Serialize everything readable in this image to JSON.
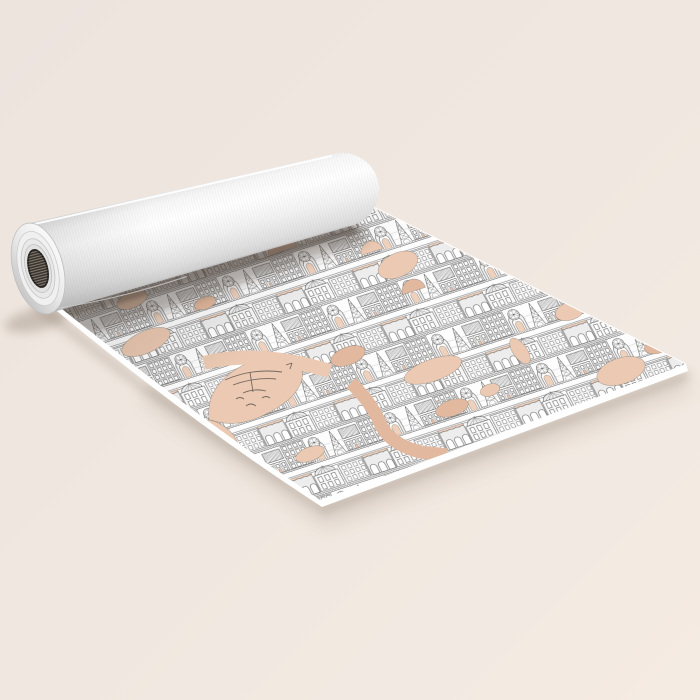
{
  "image": {
    "alt": "Yoga mat partially unrolled on a cream floor, printed with a black and white Paris architectural toile pattern with blush peach accents; the far end is rolled up showing a white roll with a dark core"
  },
  "colors": {
    "background_top": "#ece4dd",
    "background_bottom": "#f4ebe3",
    "mat_base": "#fdfdfd",
    "ink": "#3f3e3d",
    "accent_peach": "#ebc9b2",
    "accent_peach_deep": "#e2b89e",
    "mat_edge_white": "#ffffff",
    "roll_edge_shade": "#e2e2e2",
    "roll_highlight": "#ffffff",
    "roll_mid": "#f2f2f2",
    "roll_shade": "#c8c8c8",
    "cap_dark": "#c9c9c9",
    "cap_light": "#f7f7f7",
    "core_dark": "#36302a",
    "core_rib": "#9b948b",
    "shadow": "#6f5b4c"
  }
}
